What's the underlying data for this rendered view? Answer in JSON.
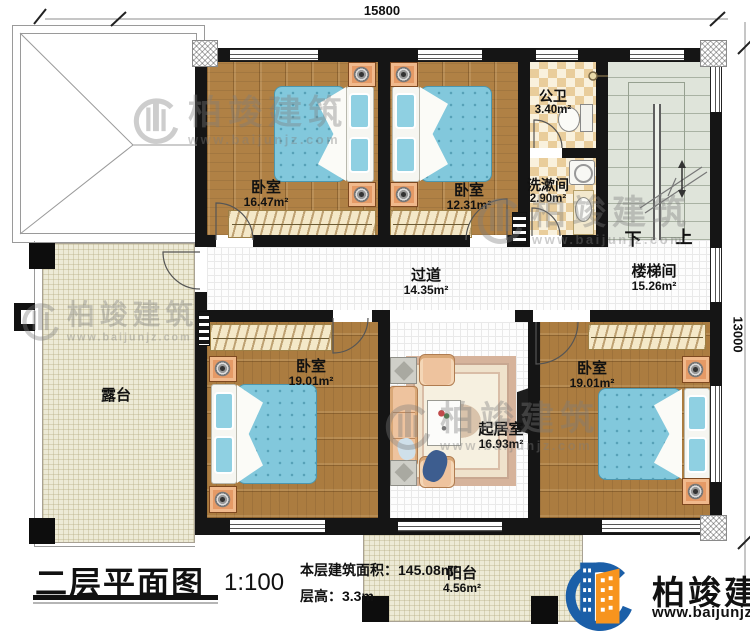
{
  "dimensions": {
    "width_mm": "15800",
    "height_mm": "13000"
  },
  "rooms": [
    {
      "name": "卧室",
      "area": "16.47m²"
    },
    {
      "name": "卧室",
      "area": "12.31m²"
    },
    {
      "name": "公卫",
      "area": "3.40m²"
    },
    {
      "name": "洗漱间",
      "area": "2.90m²"
    },
    {
      "name": "楼梯间",
      "area": "15.26m²"
    },
    {
      "name": "过道",
      "area": "14.35m²"
    },
    {
      "name": "露台",
      "area": ""
    },
    {
      "name": "卧室",
      "area": "19.01m²"
    },
    {
      "name": "起居室",
      "area": "16.93m²"
    },
    {
      "name": "卧室",
      "area": "19.01m²"
    },
    {
      "name": "阳台",
      "area": "4.56m²"
    }
  ],
  "stairs": {
    "down_label": "下",
    "up_label": "上"
  },
  "title_block": {
    "title": "二层平面图",
    "scale": "1:100",
    "area_label": "本层建筑面积：",
    "area_value": "145.08m²",
    "floor_height_label": "层高：",
    "floor_height_value": "3.3m"
  },
  "brand": {
    "name": "柏竣建筑",
    "website": "www.baijunjz.com"
  },
  "watermark": {
    "name": "柏竣建筑",
    "website": "www.baijunjz.com"
  },
  "colors": {
    "wall": "#151515",
    "wood_floor": "#b08145",
    "mattress_blue": "#82c8dc",
    "tile_cream": "#edead6",
    "brand_blue": "#1b5fa8",
    "brand_orange": "#f7941e"
  }
}
